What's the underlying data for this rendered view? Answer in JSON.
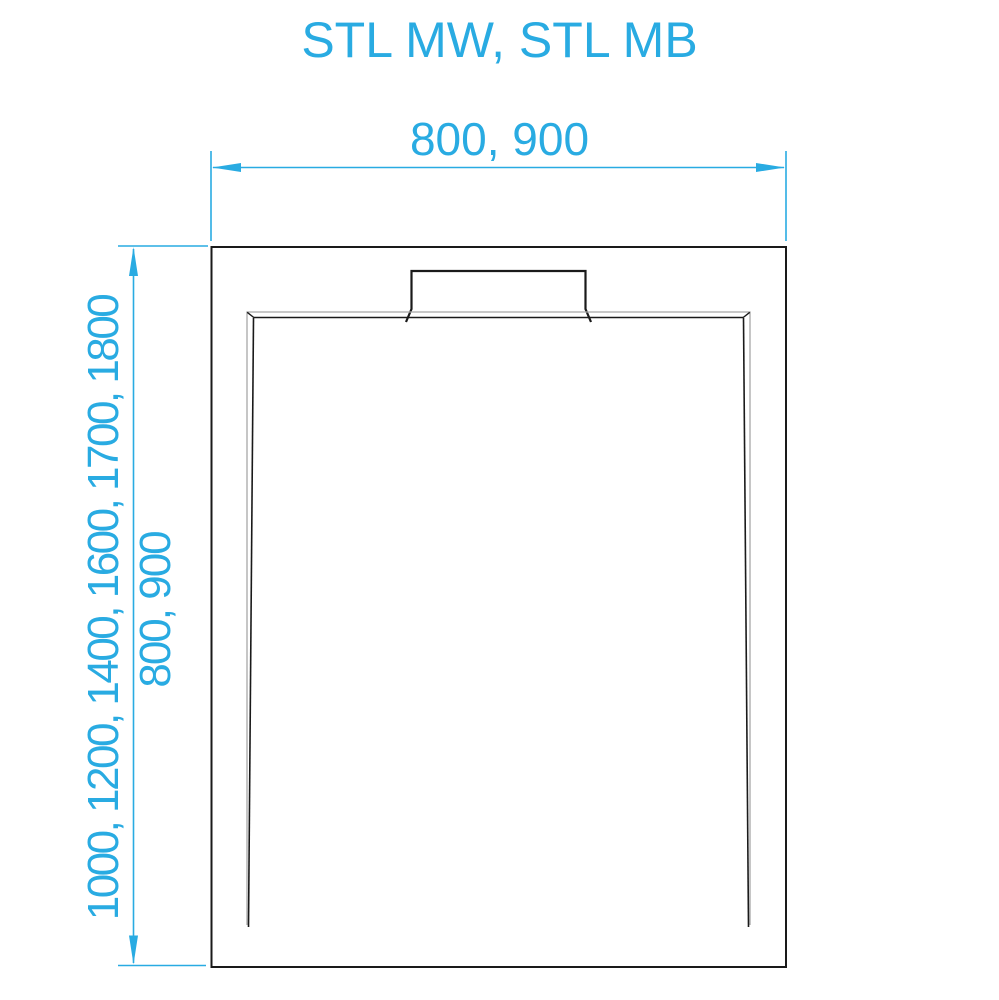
{
  "title": "STL MW, STL MB",
  "dimensions": {
    "width": {
      "label": "800, 900"
    },
    "length": {
      "label": "1000, 1200, 1400, 1600, 1700, 1800",
      "secondary_label": "800, 900"
    }
  },
  "colors": {
    "accent": "#29ABE2",
    "line_dark": "#1A1A1A",
    "rim_light": "#A8A8A8",
    "background": "#FFFFFF"
  }
}
